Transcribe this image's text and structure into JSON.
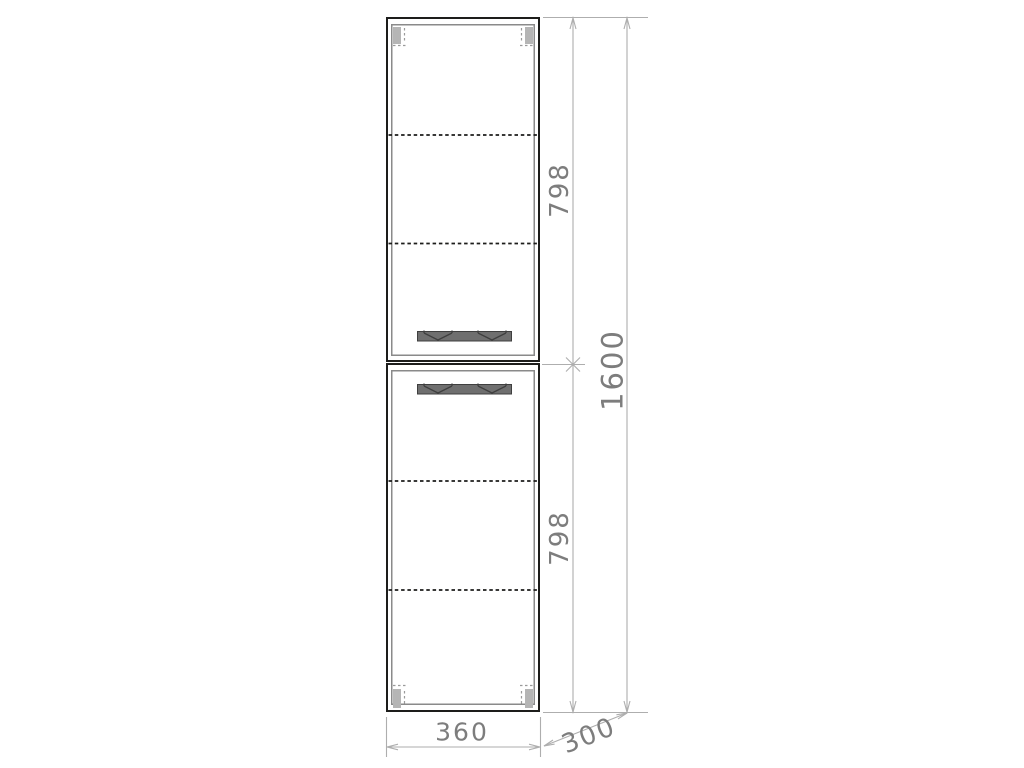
{
  "drawing": {
    "dimensions": {
      "upper_section_height": "798",
      "lower_section_height": "798",
      "total_height": "1600",
      "width": "360",
      "depth": "300"
    }
  },
  "colors": {
    "background": "#ffffff",
    "carcass-line": "#1d1d1b",
    "door-line": "#8a8a8a",
    "shelf-line": "#1d1d1b",
    "handle-fill": "#6f6f6f",
    "handle-stroke": "#3f3f3f",
    "hinge-fill": "#b5b5b5",
    "hinge-mark": "#9a9a9a",
    "dim-line": "#aeaeae",
    "dim-text": "#7d7d7d"
  }
}
